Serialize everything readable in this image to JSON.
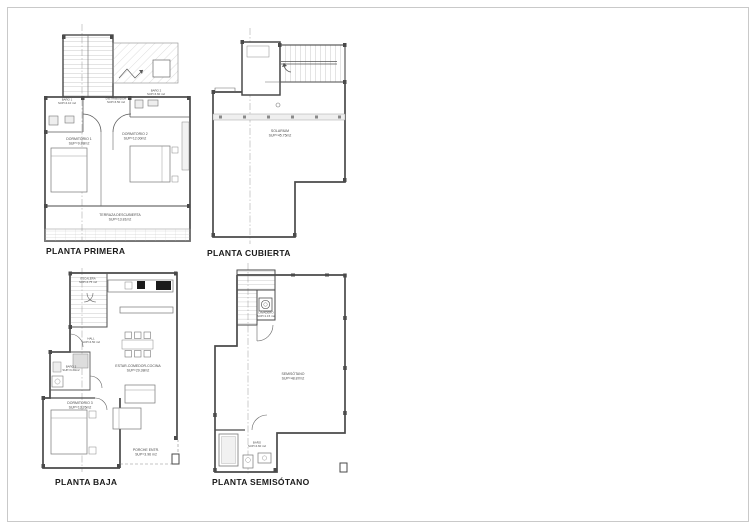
{
  "sheet": {
    "border_color": "#c9c9c9",
    "line_color": "#4a4a4a"
  },
  "plans": {
    "primera": {
      "title": "PLANTA PRIMERA",
      "rooms": [
        {
          "name": "BAÑO 1",
          "area": "SUP=4.10 m2"
        },
        {
          "name": "DISTRIBUIDOR",
          "area": "SUP=3.50 m2"
        },
        {
          "name": "BAÑO 2",
          "area": "SUP=3.60 m2"
        },
        {
          "name": "DORMITORIO 1",
          "area": "SUP=9.88m2"
        },
        {
          "name": "DORMITORIO 2",
          "area": "SUP=12.00m2"
        },
        {
          "name": "TERRAZA DESCUBIERTA",
          "area": "SUP=13.81m2"
        }
      ]
    },
    "cubierta": {
      "title": "PLANTA CUBIERTA",
      "rooms": [
        {
          "name": "SOLARIUM",
          "area": "SUP=45.75m2"
        }
      ]
    },
    "baja": {
      "title": "PLANTA BAJA",
      "rooms": [
        {
          "name": "ESCALERA",
          "area": "SUP=4.75 m2"
        },
        {
          "name": "HALL",
          "area": "SUP=4.50 m2"
        },
        {
          "name": "BAÑO 3",
          "area": "SUP=3.30m2"
        },
        {
          "name": "ESTAR-COMEDOR-COCINA",
          "area": "SUP=29.38m2"
        },
        {
          "name": "DORMITORIO 3",
          "area": "SUP=13.26m2"
        },
        {
          "name": "PORCHE ENTR.",
          "area": "SUP=3.96 m2"
        }
      ]
    },
    "semisotano": {
      "title": "PLANTA SEMISÓTANO",
      "rooms": [
        {
          "name": "LAVADERO",
          "area": "SUP=1.15 m2"
        },
        {
          "name": "SEMISÓTANO",
          "area": "SUP=48.87m2"
        },
        {
          "name": "BAÑO",
          "area": "SUP=4.60 m2"
        }
      ]
    }
  }
}
